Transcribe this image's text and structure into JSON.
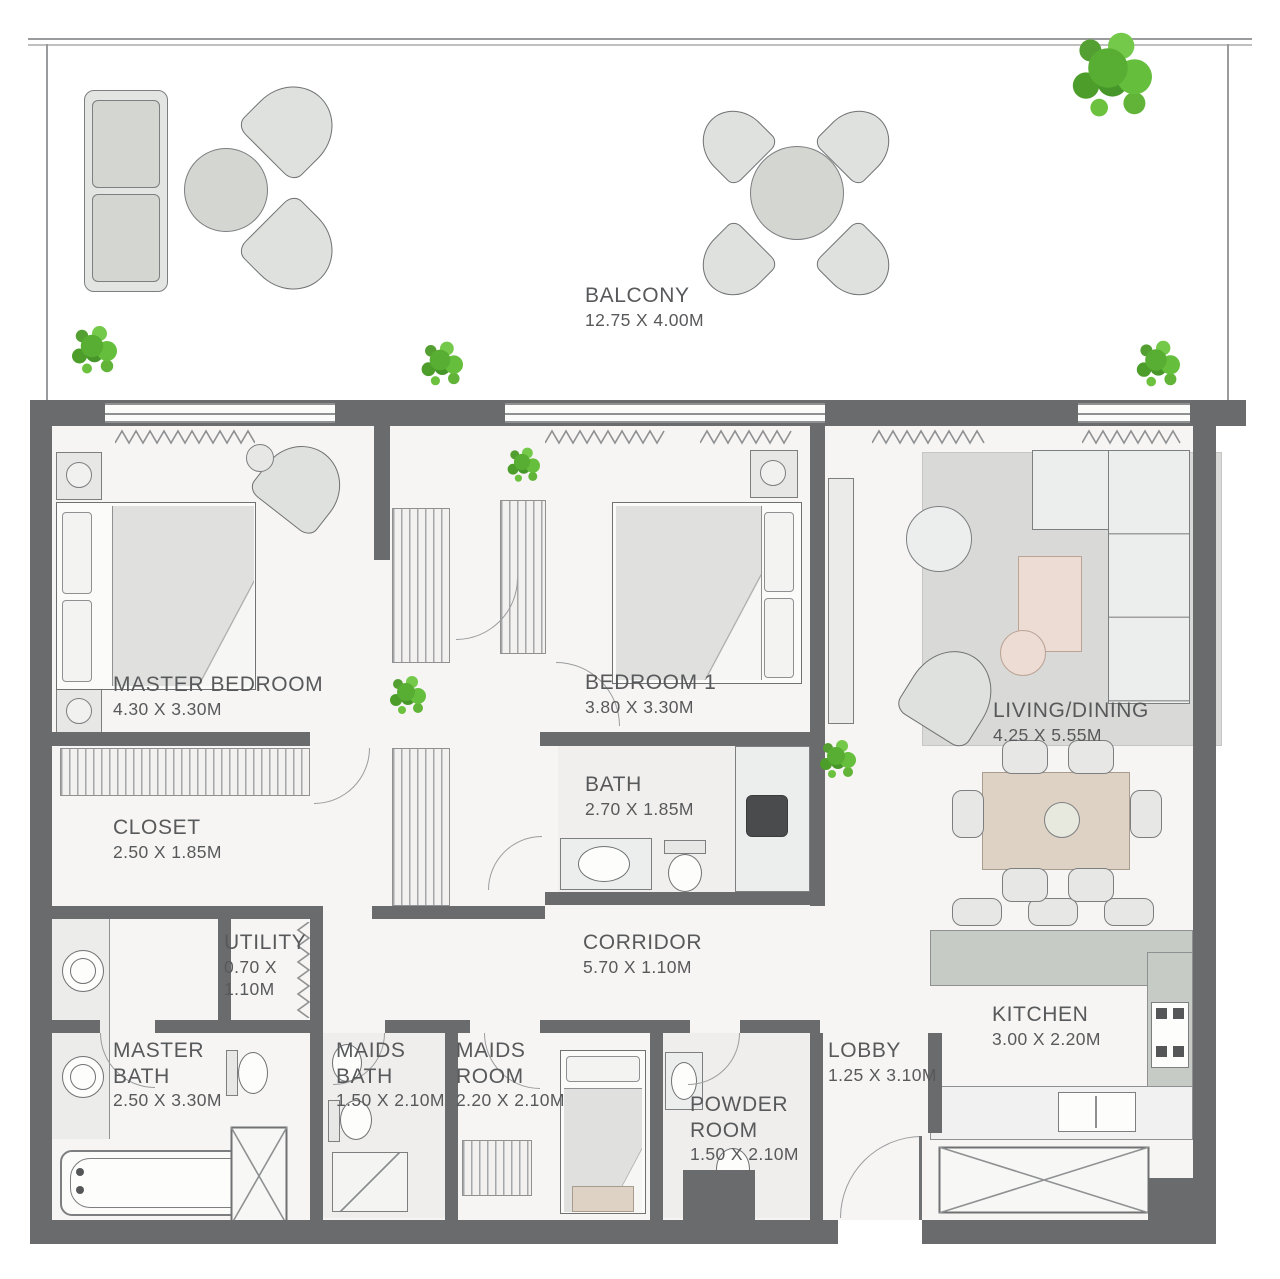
{
  "rooms": {
    "balcony": {
      "name": "BALCONY",
      "dims": "12.75 X 4.00M"
    },
    "master_bedroom": {
      "name": "MASTER BEDROOM",
      "dims": "4.30 X 3.30M"
    },
    "bedroom_1": {
      "name": "BEDROOM 1",
      "dims": "3.80 X 3.30M"
    },
    "living_dining": {
      "name": "LIVING/DINING",
      "dims": "4.25 X 5.55M"
    },
    "closet": {
      "name": "CLOSET",
      "dims": "2.50 X 1.85M"
    },
    "bath": {
      "name": "BATH",
      "dims": "2.70 X 1.85M"
    },
    "corridor": {
      "name": "CORRIDOR",
      "dims": "5.70 X 1.10M"
    },
    "utility": {
      "name": "UTILITY",
      "dims": "0.70 X 1.10M"
    },
    "master_bath": {
      "name": "MASTER BATH",
      "dims": "2.50 X 3.30M"
    },
    "maids_bath": {
      "name": "MAIDS BATH",
      "dims": "1.50 X 2.10M"
    },
    "maids_room": {
      "name": "MAIDS ROOM",
      "dims": "2.20 X 2.10M"
    },
    "powder_room": {
      "name": "POWDER ROOM",
      "dims": "1.50 X 2.10M"
    },
    "lobby": {
      "name": "LOBBY",
      "dims": "1.25 X 3.10M"
    },
    "kitchen": {
      "name": "KITCHEN",
      "dims": "3.00 X 2.20M"
    }
  },
  "colors": {
    "wall": "#6a6b6d",
    "floor": "#f6f5f4",
    "label_text": "#58595b",
    "tree_green": "#58ad33",
    "rug": "#d9dad7",
    "wood": "#ded2c4",
    "blush": "#ecdcd4"
  }
}
